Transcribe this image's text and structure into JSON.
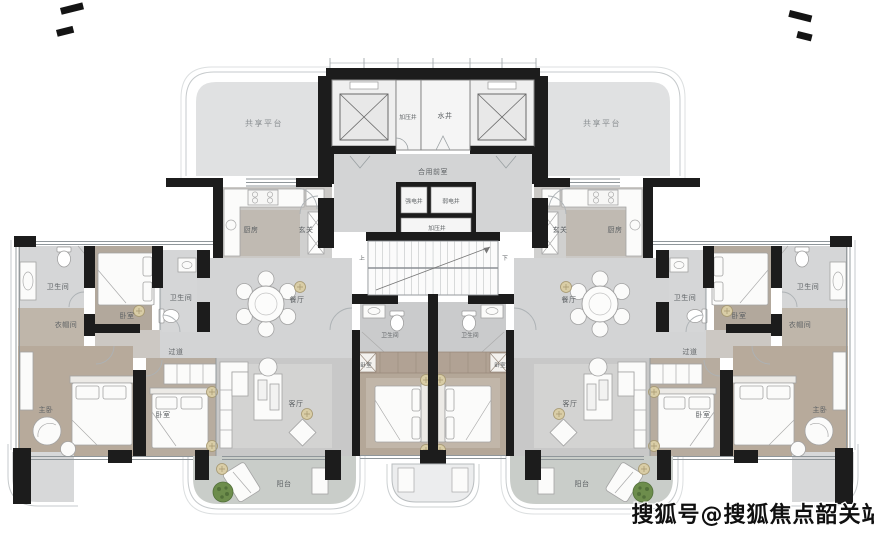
{
  "watermark": "搜狐号@搜狐焦点韶关站",
  "colors": {
    "wall": "#1c1c1c",
    "floor_common": "#d3d4d5",
    "floor_platform": "#e0e1e2",
    "floor_bedroom": "#b6a99b",
    "floor_balcony": "#c9cdc9",
    "plant_green": "#6d8d4c",
    "lamp_tan": "#d9cda6",
    "label_text": "#5d6164"
  },
  "core": {
    "shared_platform_left": "共享平台",
    "shared_platform_right": "共享平台",
    "pressurization_shaft_top": "加压井",
    "water_shaft": "水井",
    "shared_front_room": "合用前室",
    "strong_electric_shaft": "强电井",
    "weak_electric_shaft": "弱电井",
    "pressurization_shaft_mid": "加压井",
    "stair_up": "上",
    "stair_down": "下"
  },
  "left_unit": {
    "kitchen": "厨房",
    "entry": "玄关",
    "dining": "餐厅",
    "living": "客厅",
    "balcony": "阳台",
    "corridor": "过道",
    "master_bedroom": "主卧",
    "bedroom_side": "卧室",
    "bedroom_2": "卧室",
    "bedroom_center": "卧室",
    "bathroom_master": "卫生间",
    "bathroom_common": "卫生间",
    "bathroom_center": "卫生间",
    "cloakroom": "衣帽间"
  },
  "right_unit": {
    "kitchen": "厨房",
    "entry": "玄关",
    "dining": "餐厅",
    "living": "客厅",
    "balcony": "阳台",
    "corridor": "过道",
    "master_bedroom": "主卧",
    "bedroom_side": "卧室",
    "bedroom_2": "卧室",
    "bedroom_center": "卧室",
    "bathroom_master": "卫生间",
    "bathroom_common": "卫生间",
    "bathroom_center": "卫生间",
    "cloakroom": "衣帽间"
  }
}
